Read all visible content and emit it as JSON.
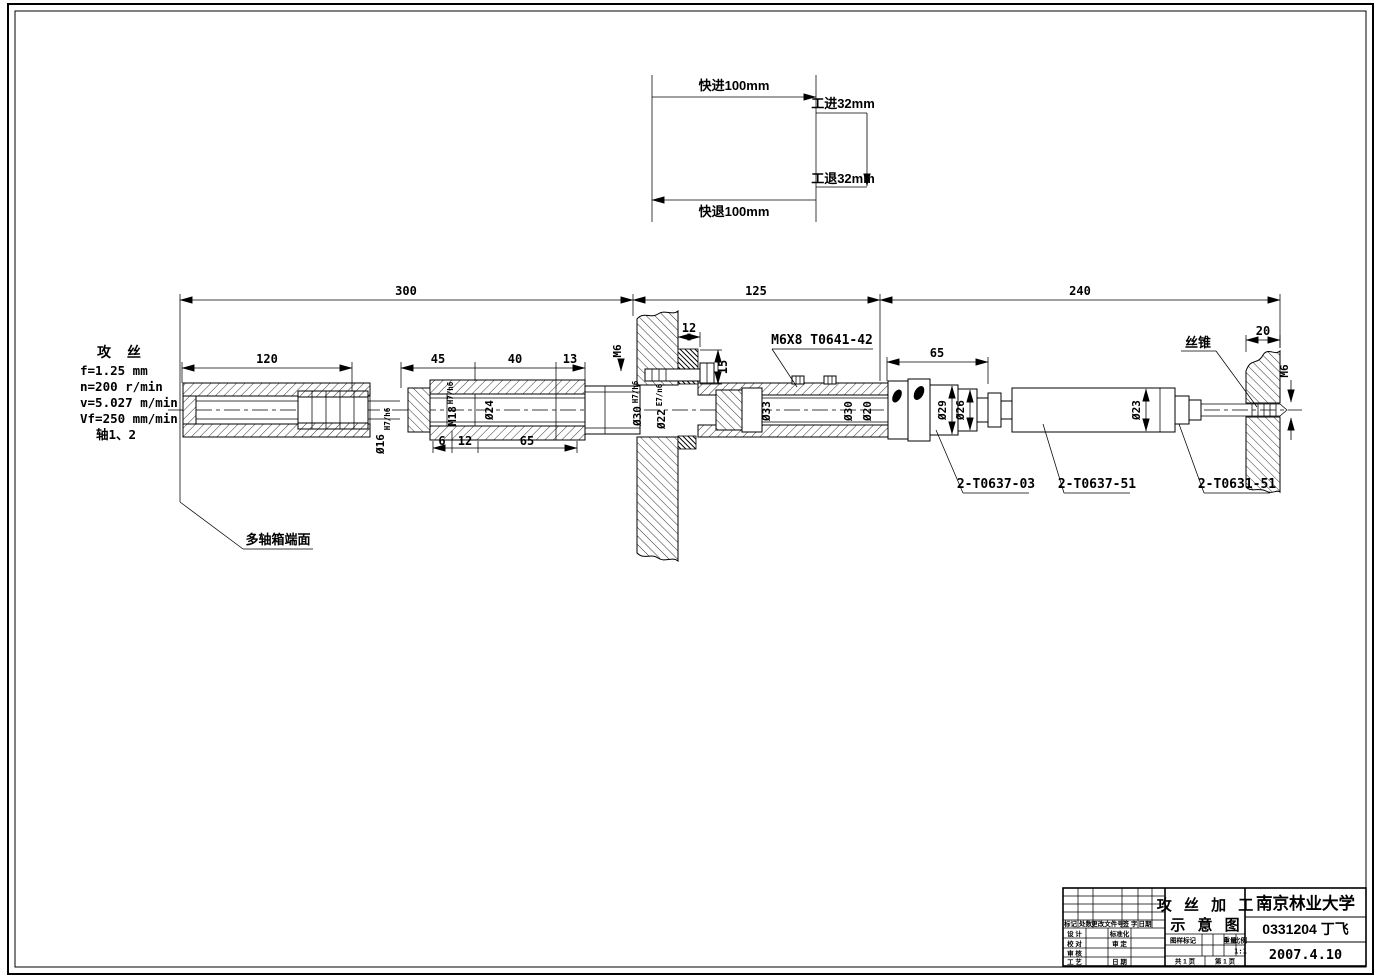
{
  "sheet": {
    "background": "#ffffff",
    "line_color": "#000000"
  },
  "motion_diagram": {
    "rapid_advance": "快进100mm",
    "work_feed": "工进32mm",
    "work_retract": "工退32mm",
    "rapid_return": "快退100mm"
  },
  "process_notes": {
    "title": "攻 丝",
    "feed": "f=1.25 mm",
    "speed": "n=200 r/min",
    "velocity": "v=5.027 m/min",
    "feed_rate": "Vf=250 mm/min",
    "axes": "轴1、2"
  },
  "dimensions": {
    "overall_left": "300",
    "overall_mid": "125",
    "overall_right": "240",
    "seg_120": "120",
    "seg_45": "45",
    "seg_40": "40",
    "seg_13": "13",
    "seg_6": "6",
    "seg_12": "12",
    "seg_65": "65",
    "plate_12": "12",
    "plate_15": "15",
    "sleeve_65": "65",
    "workpiece_20": "20"
  },
  "diameters": {
    "d16": "Ø16",
    "d16_fit": "H7/h6",
    "m18": "M18",
    "m18_fit": "H7/h6",
    "d24": "Ø24",
    "d30_left": "Ø30",
    "d30_left_fit": "H7/h6",
    "d22": "Ø22",
    "d22_fit": "E7/n6",
    "d33": "Ø33",
    "d30_right": "Ø30",
    "d20": "Ø20",
    "d29": "Ø29",
    "d26": "Ø26",
    "d23": "Ø23",
    "m6_plate": "M6",
    "m6_workpiece": "M6"
  },
  "callouts": {
    "set_screw": "M6X8  T0641-42",
    "tap": "丝锥",
    "spindle_box_face": "多轴箱端面",
    "part_1": "2-T0637-03",
    "part_2": "2-T0637-51",
    "part_3": "2-T0631-51"
  },
  "title_block": {
    "drawing_title_line1": "攻 丝 加 工",
    "drawing_title_line2": "示 意 图",
    "organization": "南京林业大学",
    "author": "0331204 丁飞",
    "date": "2007.4.10",
    "revision_header": {
      "mark": "标记",
      "count": "处数",
      "change_doc": "更改文件号",
      "signature": "签 字",
      "date": "日期"
    },
    "roles": {
      "design": "设 计",
      "proofread": "校 对",
      "review": "审 核",
      "process": "工 艺",
      "standardize": "标准化",
      "approve": "审 定",
      "date": "日 期"
    },
    "stamp": {
      "drawing_mark": "图样标记",
      "weight": "重量",
      "scale": "比例",
      "scale_value": "1:1",
      "sheet_total": "共 1 页",
      "sheet_number": "第 1 页"
    }
  }
}
